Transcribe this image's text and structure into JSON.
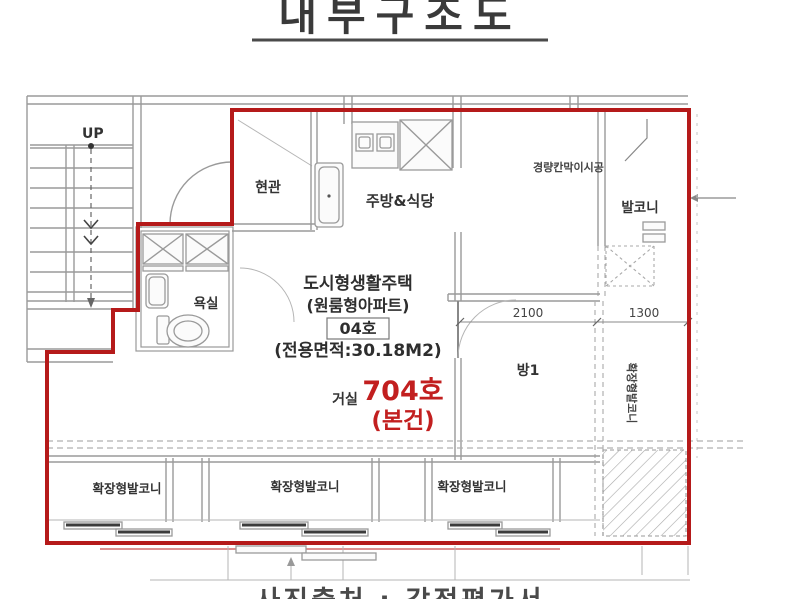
{
  "title": "내부구조도",
  "caption": "사진출처 : 감정평가서",
  "stairs": {
    "up_label": "UP"
  },
  "rooms": {
    "entrance": "현관",
    "kitchen_dining": "주방&식당",
    "balcony": "발코니",
    "bathroom": "욕실",
    "living": "거실",
    "room1": "방1",
    "ext_balcony": "확장형발코니"
  },
  "annotations": {
    "partition": "경량칸막이시공"
  },
  "unit_info": {
    "line1": "도시형생활주택",
    "line2": "(원룸형아파트)",
    "unit_box": "04호",
    "area": "(전용면적:30.18M2)"
  },
  "highlight": {
    "unit": "704호",
    "subject": "(본건)"
  },
  "dimensions": {
    "room1_width": "2100",
    "balcony_width": "1300"
  },
  "colors": {
    "boundary_red": "#b51a1a",
    "highlight_red": "#c21f1f",
    "line_gray": "#9a9a9a",
    "text_dark": "#2b2b2b"
  }
}
